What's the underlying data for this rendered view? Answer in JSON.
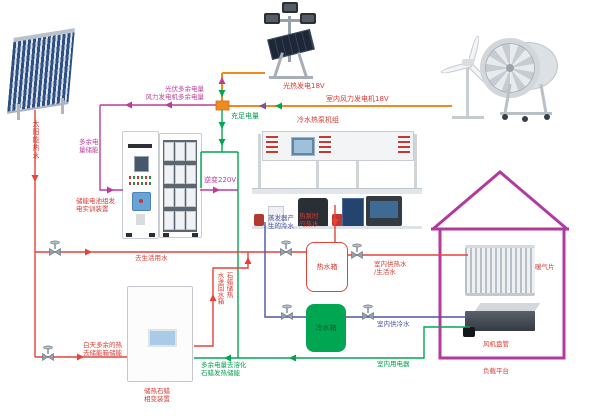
{
  "diagram": {
    "solar_hot_water": "太阳能热水",
    "excess_power": {
      "line1": "光伏多余电量",
      "line2": "风力发电机多余电量"
    },
    "sufficient_power": "充足电量",
    "pv_generation": "光热发电18V",
    "indoor_wind_generator": "室内风力发电机18V",
    "heat_pump_unit": "冷水热泵机组",
    "store_excess": {
      "line1": "多余电",
      "line2": "量储能"
    },
    "battery_device": {
      "line1": "储能电池组发",
      "line2": "电实训装置"
    },
    "inverter": "逆变220V",
    "evaporator_cold": {
      "line1": "蒸发器产",
      "line2": "生的冷水"
    },
    "heat_pump_hot": {
      "line1": "热泵时",
      "line2": "的热水"
    },
    "domestic_water": "去生活用水",
    "hot_tank": "热水箱",
    "cold_tank": "冷水箱",
    "indoor_hot": {
      "line1": "室内供热水",
      "line2": "/生活水"
    },
    "indoor_cold": "室内供冷水",
    "indoor_appliances": "室内用电器",
    "radiator": "暖气片",
    "fan_coil": "风机盘管",
    "load_platform": "负载平台",
    "day_excess": {
      "line1": "白天多余的热",
      "line2": "去储能箱储能"
    },
    "paraffin_device": {
      "line1": "储热石蜡",
      "line2": "相变装置"
    },
    "melt_paraffin": {
      "line1": "多余电量去溶化",
      "line2": "石蜡发热储能"
    },
    "paraffin_return": {
      "col1": "石蜡储热",
      "col2": "水送回水箱"
    }
  },
  "colors": {
    "hot_water_red": "#e8413a",
    "cold_water_blue": "#4a55a5",
    "power_green": "#00a651",
    "excess_magenta": "#bb3d9b",
    "wire_orange": "#ef8a1f",
    "purple_arrow": "#7d4fa0",
    "house_outline": "#b23a9e",
    "cold_tank_fill": "#00a651"
  }
}
